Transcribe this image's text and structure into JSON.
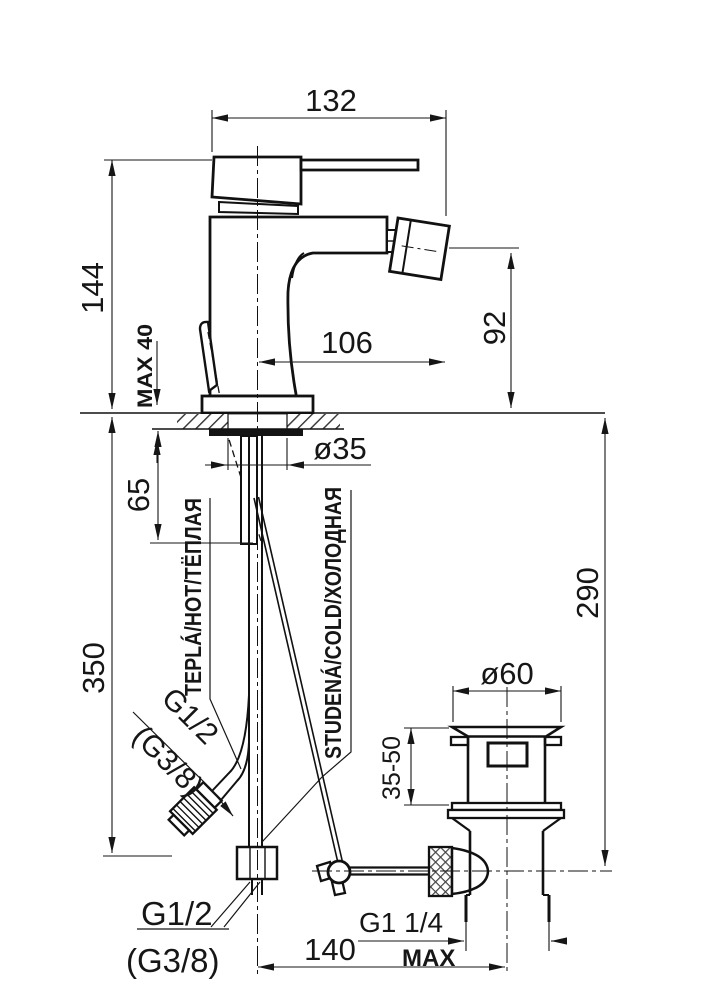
{
  "dims": {
    "w132": "132",
    "h144": "144",
    "max40": "MAX 40",
    "reach106": "106",
    "spout92": "92",
    "shank65": "65",
    "hole35": "ø35",
    "hose350": "350",
    "drain290": "290",
    "flange60": "ø60",
    "range3550": "35-50",
    "dist140": "140",
    "g12_diag": "G1/2",
    "g38_diag": "(G3/8)",
    "g12_bottom": "G1/2",
    "g38_bottom": "(G3/8)",
    "g114": "G1 1/4",
    "max": "MAX"
  },
  "labels": {
    "hot": "TEPLÁ/HOT/ТЁПЛАЯ",
    "cold": "STUDENÁ/COLD/ХОЛОДНАЯ"
  }
}
